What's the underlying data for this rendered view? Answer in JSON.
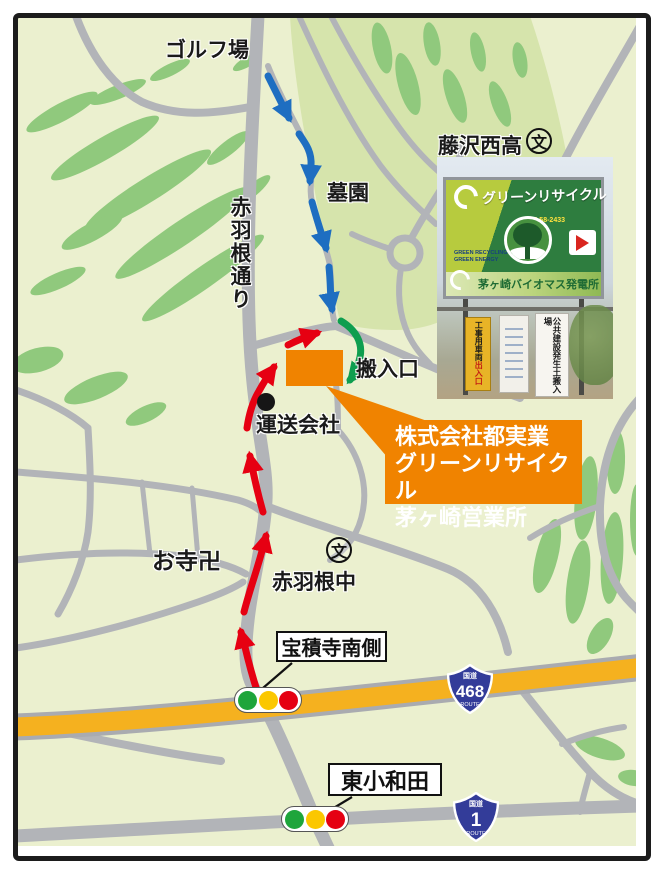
{
  "labels": {
    "golf_course": "ゴルフ場",
    "cemetery": "墓園",
    "akabane_street": "赤羽根通り",
    "fujisawa_nishi_high": "藤沢西高",
    "school_symbol": "文",
    "carry_in_entrance": "搬入口",
    "transport_company": "運送会社",
    "temple": "お寺卍",
    "akabane_junior_high": "赤羽根中"
  },
  "intersections": {
    "hoshakuji_south": "宝積寺南側",
    "higashi_kowada": "東小和田"
  },
  "route_shields": {
    "r468": {
      "prefix": "国道",
      "number": "468",
      "caption": "ROUTE"
    },
    "r1": {
      "prefix": "国道",
      "number": "1",
      "caption": "ROUTE"
    }
  },
  "destination": {
    "line1": "株式会社都実業",
    "line2": "グリーンリサイクル",
    "line3": "茅ヶ崎営業所"
  },
  "photo_sign": {
    "billboard_title": "グリーンリサイクル",
    "billboard_sub": "茅ヶ崎バイオマス発電所",
    "billboard_phone": "0467-58-2433",
    "billboard_small1": "GREEN RECYCLING",
    "billboard_small2": "GREEN ENERGY",
    "site_sign_yellow_1": "工事用車両",
    "site_sign_yellow_2": "出入口",
    "site_sign_white": "公共建設発生土搬入場"
  },
  "colors": {
    "background": "#ebf0cf",
    "cemetery_area": "#d6e4ac",
    "green_patch": "#90c97d",
    "road": "#b2b4b8",
    "highway_yellow": "#f5b11f",
    "route_red": "#e60012",
    "route_blue": "#1e6ec1",
    "route_green": "#0e9e4f",
    "accent_orange": "#f08300",
    "shield_blue": "#333c99",
    "signal_green": "#1ea53b",
    "signal_yellow": "#fbc700",
    "signal_red": "#e50012"
  }
}
